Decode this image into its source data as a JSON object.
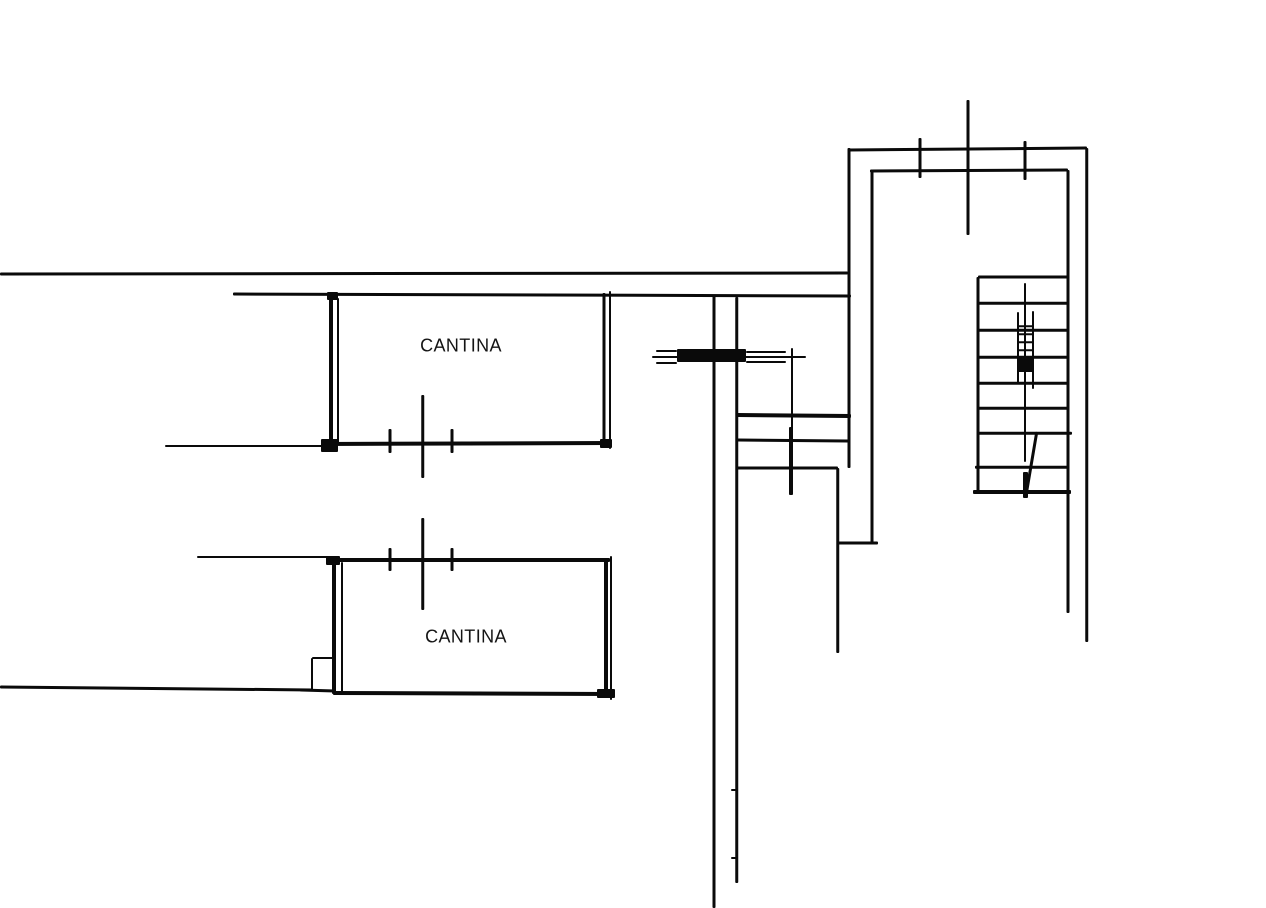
{
  "canvas": {
    "width": 1266,
    "height": 908,
    "background_color": "#ffffff",
    "ink_color": "#0a0a0a"
  },
  "plan": {
    "type": "floor-plan-sketch",
    "labels": [
      {
        "text": "CANTINA",
        "cx": 461,
        "cy": 346,
        "font_px": 18
      },
      {
        "text": "CANTINA",
        "cx": 466,
        "cy": 637,
        "font_px": 18
      }
    ],
    "segments": [
      {
        "name": "top-boundary-wall",
        "x1": 0,
        "y1": 274,
        "x2": 848,
        "y2": 273,
        "t": 3
      },
      {
        "name": "upper-wall-line",
        "x1": 233,
        "y1": 294,
        "x2": 851,
        "y2": 296,
        "t": 3
      },
      {
        "name": "cantina1-left-wall",
        "x1": 331,
        "y1": 294,
        "x2": 331,
        "y2": 446,
        "t": 4
      },
      {
        "name": "cantina1-left-wall-double",
        "x1": 338,
        "y1": 298,
        "x2": 338,
        "y2": 443,
        "t": 2
      },
      {
        "name": "cantina1-right-wall",
        "x1": 604,
        "y1": 293,
        "x2": 604,
        "y2": 445,
        "t": 3
      },
      {
        "name": "cantina1-right-wall-double",
        "x1": 610,
        "y1": 291,
        "x2": 610,
        "y2": 449,
        "t": 2
      },
      {
        "name": "cantina1-bottom-leader",
        "x1": 165,
        "y1": 446,
        "x2": 333,
        "y2": 446,
        "t": 2
      },
      {
        "name": "cantina1-bottom-wall",
        "x1": 322,
        "y1": 444,
        "x2": 612,
        "y2": 443,
        "t": 4
      },
      {
        "name": "cantina2-top-leader",
        "x1": 197,
        "y1": 557,
        "x2": 333,
        "y2": 557,
        "t": 2
      },
      {
        "name": "cantina2-top-wall",
        "x1": 329,
        "y1": 560,
        "x2": 610,
        "y2": 560,
        "t": 4
      },
      {
        "name": "cantina2-left-wall",
        "x1": 334,
        "y1": 560,
        "x2": 334,
        "y2": 694,
        "t": 4
      },
      {
        "name": "cantina2-left-wall-double",
        "x1": 342,
        "y1": 562,
        "x2": 342,
        "y2": 695,
        "t": 2
      },
      {
        "name": "cantina2-right-wall",
        "x1": 606,
        "y1": 560,
        "x2": 606,
        "y2": 696,
        "t": 4
      },
      {
        "name": "cantina2-right-wall-double",
        "x1": 611,
        "y1": 556,
        "x2": 611,
        "y2": 700,
        "t": 2
      },
      {
        "name": "cantina2-bottom-wall",
        "x1": 333,
        "y1": 693,
        "x2": 613,
        "y2": 694,
        "t": 4
      },
      {
        "name": "bottom-left-boundary",
        "x1": 0,
        "y1": 687,
        "x2": 313,
        "y2": 690,
        "t": 3
      },
      {
        "name": "notch-left",
        "x1": 312,
        "y1": 658,
        "x2": 312,
        "y2": 691,
        "t": 2
      },
      {
        "name": "notch-top",
        "x1": 312,
        "y1": 658,
        "x2": 334,
        "y2": 658,
        "t": 2
      },
      {
        "name": "notch-bottom",
        "x1": 300,
        "y1": 690,
        "x2": 336,
        "y2": 691,
        "t": 3
      },
      {
        "name": "wall-tick",
        "x1": 390,
        "y1": 429,
        "x2": 390,
        "y2": 453,
        "t": 3
      },
      {
        "name": "wall-tick",
        "x1": 452,
        "y1": 429,
        "x2": 452,
        "y2": 453,
        "t": 3
      },
      {
        "name": "wall-tick-long",
        "x1": 423,
        "y1": 395,
        "x2": 423,
        "y2": 478,
        "t": 2.5
      },
      {
        "name": "wall-tick",
        "x1": 390,
        "y1": 548,
        "x2": 390,
        "y2": 571,
        "t": 3
      },
      {
        "name": "wall-tick",
        "x1": 452,
        "y1": 548,
        "x2": 452,
        "y2": 571,
        "t": 3
      },
      {
        "name": "wall-tick-long",
        "x1": 423,
        "y1": 518,
        "x2": 423,
        "y2": 610,
        "t": 2.5
      },
      {
        "name": "corridor-left-wall",
        "x1": 714,
        "y1": 295,
        "x2": 714,
        "y2": 908,
        "t": 3
      },
      {
        "name": "corridor-right-wall",
        "x1": 737,
        "y1": 297,
        "x2": 737,
        "y2": 883,
        "t": 2.5
      },
      {
        "name": "corridor-nub",
        "x1": 731,
        "y1": 790,
        "x2": 738,
        "y2": 790,
        "t": 2
      },
      {
        "name": "corridor-nub",
        "x1": 731,
        "y1": 858,
        "x2": 738,
        "y2": 858,
        "t": 2
      },
      {
        "name": "mid-room-divider",
        "x1": 737,
        "y1": 415,
        "x2": 851,
        "y2": 416,
        "t": 4
      },
      {
        "name": "mid-room-wall",
        "x1": 737,
        "y1": 440,
        "x2": 849,
        "y2": 441,
        "t": 3
      },
      {
        "name": "mid-room-wall",
        "x1": 737,
        "y1": 468,
        "x2": 838,
        "y2": 468,
        "t": 3
      },
      {
        "name": "stairhall-outer-left-wall",
        "x1": 849,
        "y1": 148,
        "x2": 849,
        "y2": 468,
        "t": 3
      },
      {
        "name": "stairhall-inner-left-wall",
        "x1": 872,
        "y1": 170,
        "x2": 872,
        "y2": 543,
        "t": 3
      },
      {
        "name": "lower-mid-wall",
        "x1": 838,
        "y1": 468,
        "x2": 838,
        "y2": 653,
        "t": 2.5
      },
      {
        "name": "wall-jog",
        "x1": 838,
        "y1": 543,
        "x2": 878,
        "y2": 543,
        "t": 3
      },
      {
        "name": "door-axis-line",
        "x1": 652,
        "y1": 357,
        "x2": 806,
        "y2": 357,
        "t": 2
      },
      {
        "name": "door-frame-line",
        "x1": 656,
        "y1": 351,
        "x2": 677,
        "y2": 351,
        "t": 2
      },
      {
        "name": "door-frame-line",
        "x1": 656,
        "y1": 363,
        "x2": 677,
        "y2": 363,
        "t": 2
      },
      {
        "name": "door-frame-line",
        "x1": 746,
        "y1": 352,
        "x2": 786,
        "y2": 352,
        "t": 2
      },
      {
        "name": "door-frame-line",
        "x1": 746,
        "y1": 362,
        "x2": 786,
        "y2": 362,
        "t": 2
      },
      {
        "name": "door-jamb-tick",
        "x1": 792,
        "y1": 348,
        "x2": 792,
        "y2": 430,
        "t": 2
      },
      {
        "name": "door-jamb-tick-thick",
        "x1": 791,
        "y1": 427,
        "x2": 791,
        "y2": 495,
        "t": 4
      },
      {
        "name": "stairhall-outer-top-wall",
        "x1": 848,
        "y1": 150,
        "x2": 1087,
        "y2": 148,
        "t": 3
      },
      {
        "name": "stairhall-inner-top-wall",
        "x1": 870,
        "y1": 171,
        "x2": 1068,
        "y2": 170,
        "t": 3
      },
      {
        "name": "stairhall-inner-right-wall",
        "x1": 1068,
        "y1": 170,
        "x2": 1068,
        "y2": 613,
        "t": 3
      },
      {
        "name": "stairhall-outer-right-wall",
        "x1": 1087,
        "y1": 148,
        "x2": 1087,
        "y2": 642,
        "t": 2.5
      },
      {
        "name": "stair-left-wall",
        "x1": 978,
        "y1": 277,
        "x2": 978,
        "y2": 492,
        "t": 3
      },
      {
        "name": "stair-tread",
        "x1": 978,
        "y1": 277,
        "x2": 1068,
        "y2": 277,
        "t": 3
      },
      {
        "name": "stair-tread",
        "x1": 978,
        "y1": 303,
        "x2": 1068,
        "y2": 303,
        "t": 2.5
      },
      {
        "name": "stair-tread",
        "x1": 978,
        "y1": 330,
        "x2": 1068,
        "y2": 330,
        "t": 2.5
      },
      {
        "name": "stair-tread",
        "x1": 978,
        "y1": 357,
        "x2": 1068,
        "y2": 357,
        "t": 2.5
      },
      {
        "name": "stair-tread",
        "x1": 978,
        "y1": 383,
        "x2": 1068,
        "y2": 383,
        "t": 2.5
      },
      {
        "name": "stair-tread",
        "x1": 978,
        "y1": 408,
        "x2": 1068,
        "y2": 408,
        "t": 2.5
      },
      {
        "name": "stair-tread",
        "x1": 978,
        "y1": 433,
        "x2": 1072,
        "y2": 433,
        "t": 2.5
      },
      {
        "name": "stair-tread",
        "x1": 975,
        "y1": 467,
        "x2": 1068,
        "y2": 467,
        "t": 2.5
      },
      {
        "name": "stair-bottom-tread",
        "x1": 973,
        "y1": 492,
        "x2": 1071,
        "y2": 492,
        "t": 4
      },
      {
        "name": "wall-tick",
        "x1": 920,
        "y1": 138,
        "x2": 920,
        "y2": 178,
        "t": 3
      },
      {
        "name": "wall-tick",
        "x1": 1025,
        "y1": 141,
        "x2": 1025,
        "y2": 180,
        "t": 3
      },
      {
        "name": "wall-tick-long",
        "x1": 968,
        "y1": 100,
        "x2": 968,
        "y2": 235,
        "t": 3
      },
      {
        "name": "stair-break-line",
        "x1": 1018,
        "y1": 312,
        "x2": 1018,
        "y2": 383,
        "t": 2
      },
      {
        "name": "stair-break-line",
        "x1": 1033,
        "y1": 311,
        "x2": 1033,
        "y2": 389,
        "t": 2
      },
      {
        "name": "stair-break-rung",
        "x1": 1018,
        "y1": 326,
        "x2": 1033,
        "y2": 326,
        "t": 1.5
      },
      {
        "name": "stair-break-rung",
        "x1": 1018,
        "y1": 334,
        "x2": 1033,
        "y2": 334,
        "t": 1.5
      },
      {
        "name": "stair-break-rung",
        "x1": 1018,
        "y1": 342,
        "x2": 1033,
        "y2": 342,
        "t": 1.5
      },
      {
        "name": "stair-break-rung",
        "x1": 1018,
        "y1": 350,
        "x2": 1033,
        "y2": 350,
        "t": 1.5
      },
      {
        "name": "stair-center-line",
        "x1": 1025,
        "y1": 283,
        "x2": 1025,
        "y2": 462,
        "t": 2
      },
      {
        "name": "stair-arrow-diagonal",
        "x1": 1037,
        "y1": 432,
        "x2": 1026,
        "y2": 497,
        "t": 2.5
      }
    ],
    "blobs": [
      {
        "name": "door-leaf",
        "x": 677,
        "y": 349,
        "w": 69,
        "h": 13
      },
      {
        "name": "stair-break-fill",
        "x": 1017,
        "y": 358,
        "w": 17,
        "h": 14
      },
      {
        "name": "stair-arrow-head",
        "x": 1023,
        "y": 472,
        "w": 5,
        "h": 26
      },
      {
        "name": "ink-corner",
        "x": 321,
        "y": 439,
        "w": 17,
        "h": 13
      },
      {
        "name": "ink-corner",
        "x": 326,
        "y": 556,
        "w": 14,
        "h": 9
      },
      {
        "name": "ink-corner",
        "x": 327,
        "y": 292,
        "w": 11,
        "h": 8
      },
      {
        "name": "ink-corner",
        "x": 600,
        "y": 439,
        "w": 12,
        "h": 9
      },
      {
        "name": "ink-corner",
        "x": 597,
        "y": 689,
        "w": 18,
        "h": 9
      }
    ]
  }
}
